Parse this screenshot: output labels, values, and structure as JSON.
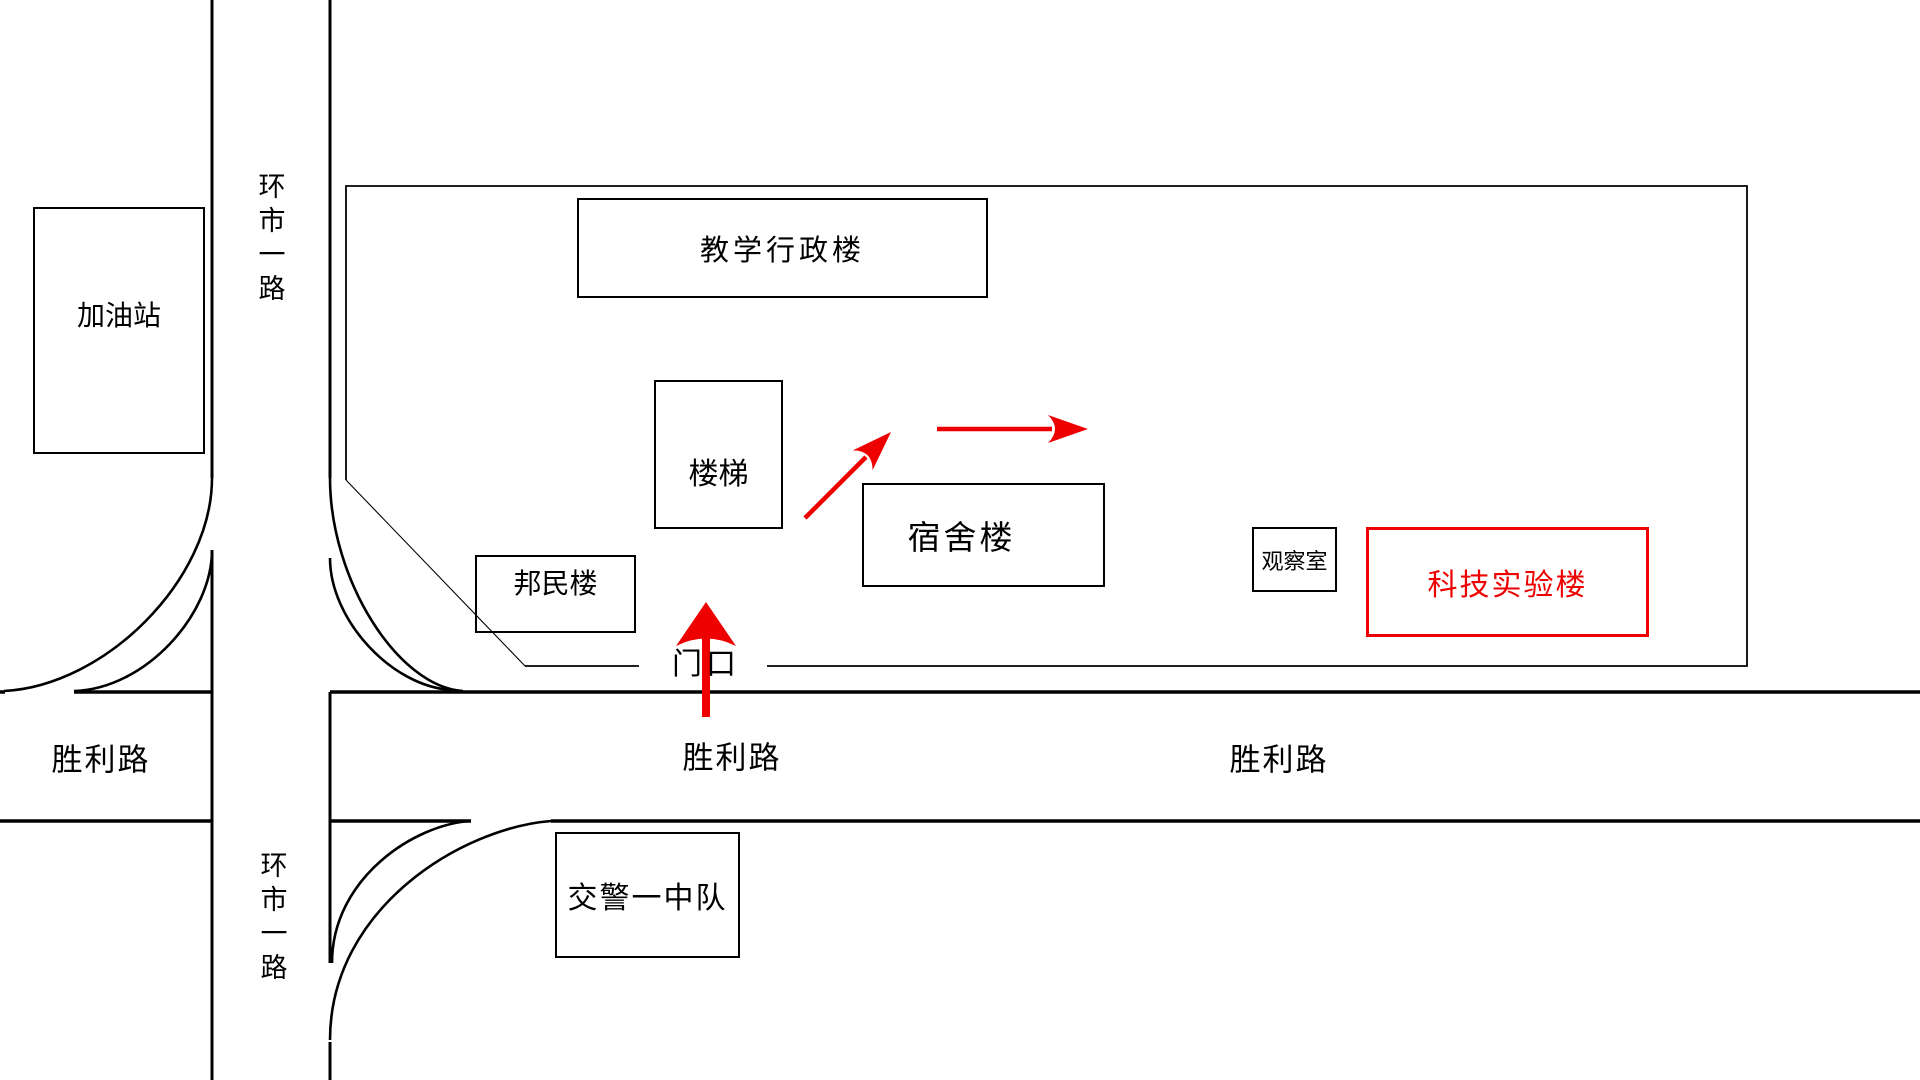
{
  "colors": {
    "accent_red": "#ee0000",
    "line_black": "#000000",
    "background": "#ffffff"
  },
  "buildings": [
    {
      "id": "gas-station",
      "label": "加油站"
    },
    {
      "id": "teaching-admin",
      "label": "教学行政楼"
    },
    {
      "id": "stairs",
      "label": "楼梯"
    },
    {
      "id": "bangmin-building",
      "label": "邦民楼"
    },
    {
      "id": "dormitory",
      "label": "宿舍楼"
    },
    {
      "id": "observation-room",
      "label": "观察室"
    },
    {
      "id": "sci-tech-lab",
      "label": "科技实验楼",
      "highlighted": true
    },
    {
      "id": "traffic-police-squad-1",
      "label": "交警一中队"
    }
  ],
  "roads": {
    "huanshi_road_top_label": "环市一路",
    "huanshi_road_bottom_label": "环市一路",
    "shengli_road_labels": [
      "胜利路",
      "胜利路",
      "胜利路"
    ]
  },
  "gate": {
    "label": "门口"
  },
  "route_arrows": [
    {
      "icon": "arrow-up-icon"
    },
    {
      "icon": "arrow-up-right-icon"
    },
    {
      "icon": "arrow-right-icon"
    }
  ]
}
